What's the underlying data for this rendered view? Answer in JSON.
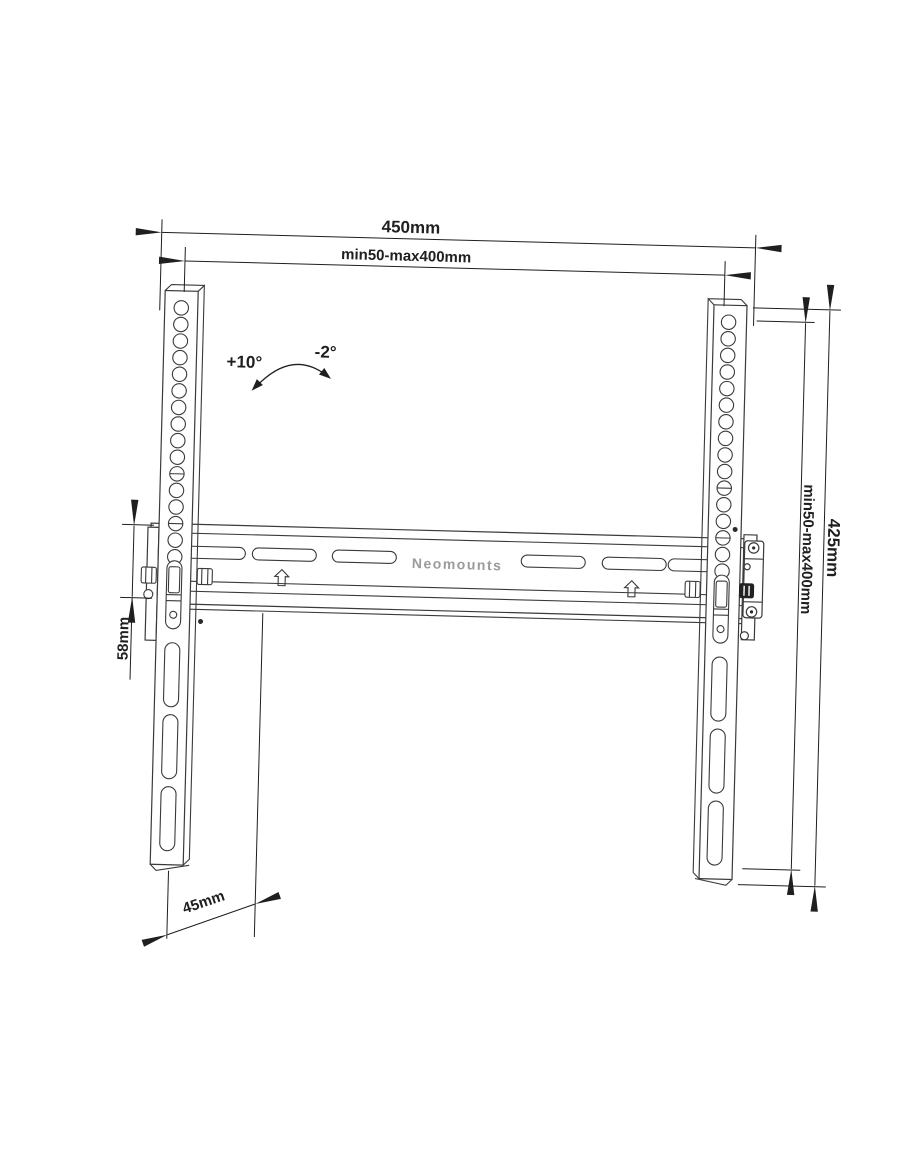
{
  "page": {
    "background": "#ffffff"
  },
  "drawing": {
    "brand": "Neomounts",
    "colors": {
      "line": "#3a3a3a",
      "dimension_line": "#1f1f1f",
      "brand_text": "#9b9b9b",
      "background": "#ffffff"
    },
    "icons": {
      "rail_arrow": "up-arrow",
      "tilt_arrow": "curved-double-arrow",
      "dimension_arrow": "filled-triangle-arrowhead"
    },
    "dimensions": {
      "overall_width": "450mm",
      "vesa_width_range": "min50-max400mm",
      "vesa_height_range": "min50-max400mm",
      "bracket_height": "425mm",
      "plate_height": "58mm",
      "wall_distance": "45mm"
    },
    "tilt": {
      "up_label": "+10°",
      "down_label": "-2°"
    }
  }
}
